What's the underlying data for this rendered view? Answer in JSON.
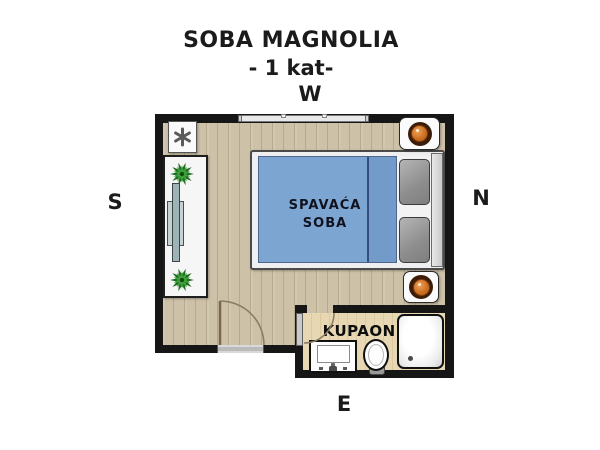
{
  "title": "SOBA MAGNOLIA",
  "subtitle": "- 1 kat-",
  "compass": {
    "w": "W",
    "n": "N",
    "s": "S",
    "e": "E"
  },
  "rooms": {
    "bedroom": {
      "label_line1": "SPAVAĆA",
      "label_line2": "SOBA"
    },
    "bathroom": {
      "label": "KUPAONICA"
    }
  },
  "colors": {
    "wall": "#161616",
    "bedroom_floor": "#cdc1a8",
    "plank_line": "#b7a98e",
    "bath_floor": "#e7d7b3",
    "bed_blue": "#7ca5d2",
    "duvet_fold": "#729bca",
    "label_navy": "#10131f",
    "lamp_orange": "#c96a1d",
    "plant_green": "#3da03d",
    "door_arc_brown": "#8a7a60"
  }
}
